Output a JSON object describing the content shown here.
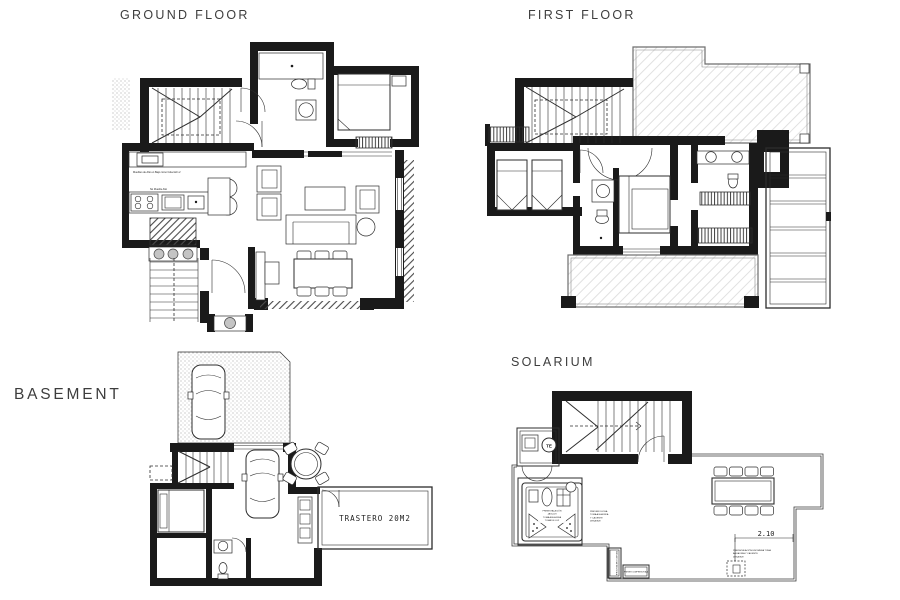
{
  "page": {
    "background": "#ffffff"
  },
  "plans": {
    "ground_floor": {
      "title": "GROUND FLOOR",
      "notes": {
        "kitchen_upper": "Muebles de Alto en Bajo como Colección 2",
        "kitchen_counter": "No Mueble Alto"
      }
    },
    "first_floor": {
      "title": "FIRST FLOOR"
    },
    "basement": {
      "title": "BASEMENT",
      "labels": {
        "storage_room": "TRASTERO 20M2"
      }
    },
    "solarium": {
      "title": "SOLARIUM",
      "labels": {
        "water_heater": "TE",
        "dimension": "2.10"
      },
      "notes": {
        "jacuzzi": [
          "PREINSTALACIÓN",
          "JACUZZI",
          "TOMA AGUA FRIA",
          "TOMA DE LUZ"
        ],
        "shower": [
          "PREVER DUCHA",
          "TOMA AGUA FRIA",
          "Y CALIENTE",
          "DESAGÜE"
        ],
        "counter": [
          "PREINSTALACIÓN ENCIMERA TOMA",
          "AGUA FRIA Y CALIENTE",
          "DESAGÜE"
        ],
        "compressor_side": "PREVER COMPRESOR A/A",
        "compressor_bottom": "PREVER COMPRESOR A/A"
      }
    }
  },
  "colors": {
    "wall": "#1a1a1a",
    "line": "#2d2d2d",
    "title_text": "#3d3d3d"
  }
}
